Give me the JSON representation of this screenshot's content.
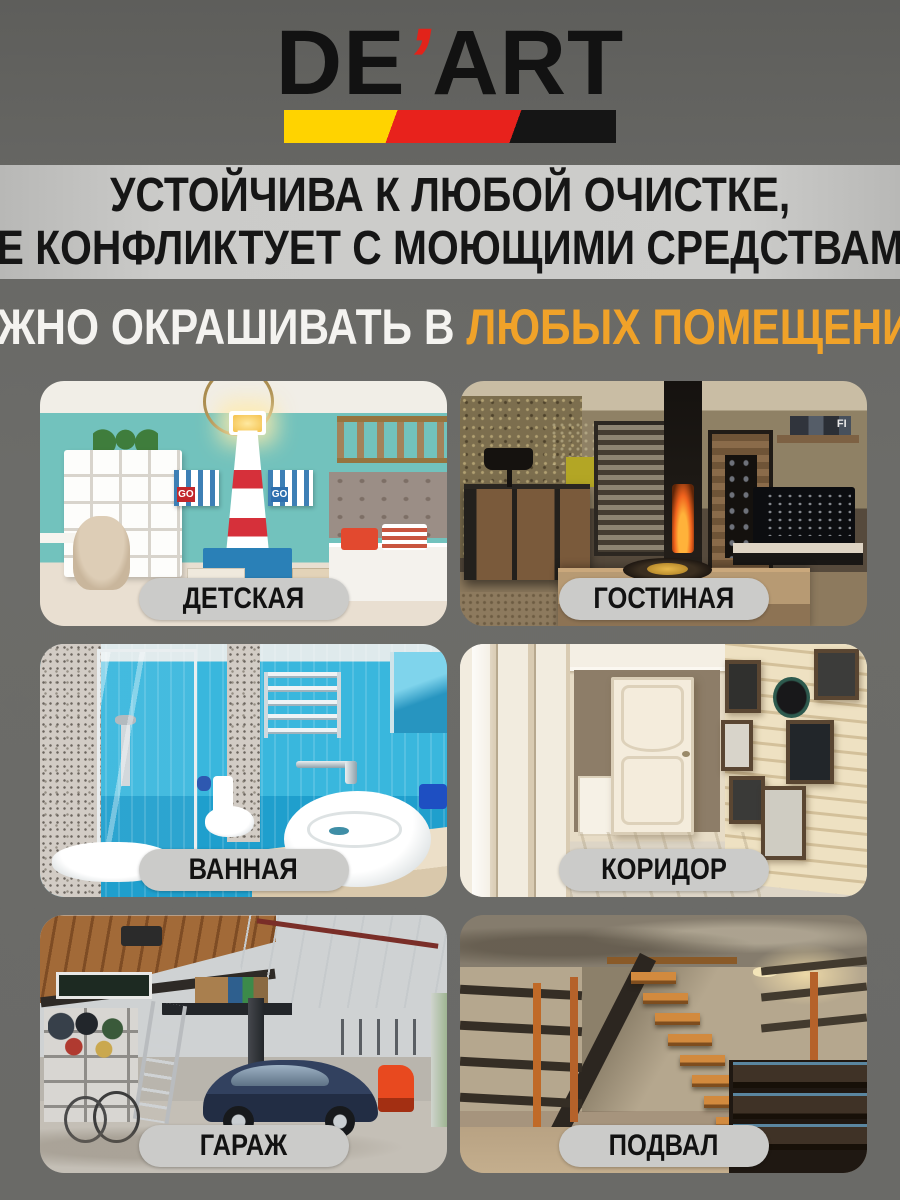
{
  "brand": {
    "name": "DE'ART",
    "text_left": "DE",
    "apostrophe": "’",
    "text_right": "ART"
  },
  "banner": {
    "line1": "УСТОЙЧИВА К ЛЮБОЙ ОЧИСТКЕ,",
    "line2": "НЕ КОНФЛИКТУЕТ С МОЮЩИМИ СРЕДСТВАМИ"
  },
  "subheadline": {
    "white_part": "МОЖНО ОКРАШИВАТЬ В ",
    "orange_part": "ЛЮБЫХ ПОМЕЩЕНИЯХ"
  },
  "rooms": [
    {
      "label": "ДЕТСКАЯ"
    },
    {
      "label": "ГОСТИНАЯ"
    },
    {
      "label": "ВАННАЯ"
    },
    {
      "label": "КОРИДОР"
    },
    {
      "label": "ГАРАЖ"
    },
    {
      "label": "ПОДВАЛ"
    }
  ],
  "photo_details": {
    "kids_flag_text": "GO",
    "living_shelf_text": "FI"
  },
  "colors": {
    "page_background": "#6A6A67",
    "banner_background": "#C9C9C7",
    "banner_text": "#161616",
    "accent_orange": "#F0A229",
    "logo_black": "#121212",
    "logo_red": "#E2231A",
    "stripe_yellow": "#FFD300",
    "stripe_red": "#E8221C",
    "stripe_black": "#151515",
    "label_pill_background": "#CBCBC9",
    "label_pill_text": "#121212"
  }
}
